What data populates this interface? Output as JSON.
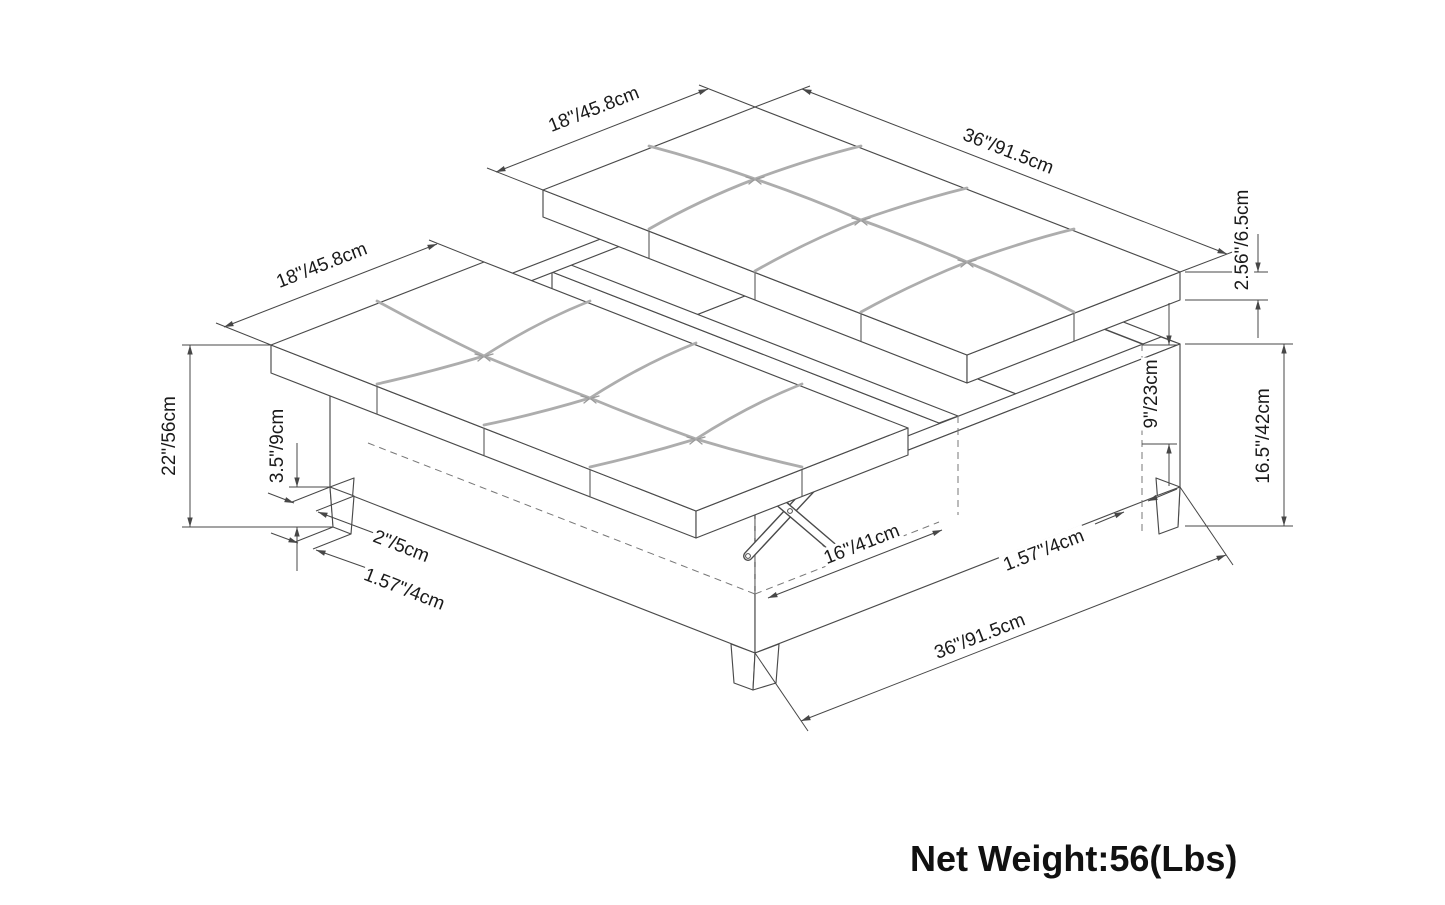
{
  "diagram": {
    "type": "furniture-dimension-diagram",
    "subject": "square lift-top storage ottoman with tufted cushions",
    "dimensions": {
      "left_lid_width": "18\"/45.8cm",
      "right_lid_width": "18\"/45.8cm",
      "top_length": "36\"/91.5cm",
      "cushion_thickness": "2.56\"/6.5cm",
      "overall_height": "22\"/56cm",
      "leg_height": "3.5\"/9cm",
      "leg_top_width": "2\"/5cm",
      "leg_bottom_width": "1.57\"/4cm",
      "opening_depth": "16\"/41cm",
      "interior_depth": "9\"/23cm",
      "base_height": "16.5\"/42cm",
      "wall_thickness": "1.57\"/4cm",
      "overall_width": "36\"/91.5cm"
    },
    "net_weight": "Net Weight:56(Lbs)",
    "colors": {
      "background": "#ffffff",
      "line": "#4a4a4a",
      "seam": "#adadad",
      "text": "#1a1a1a"
    }
  }
}
